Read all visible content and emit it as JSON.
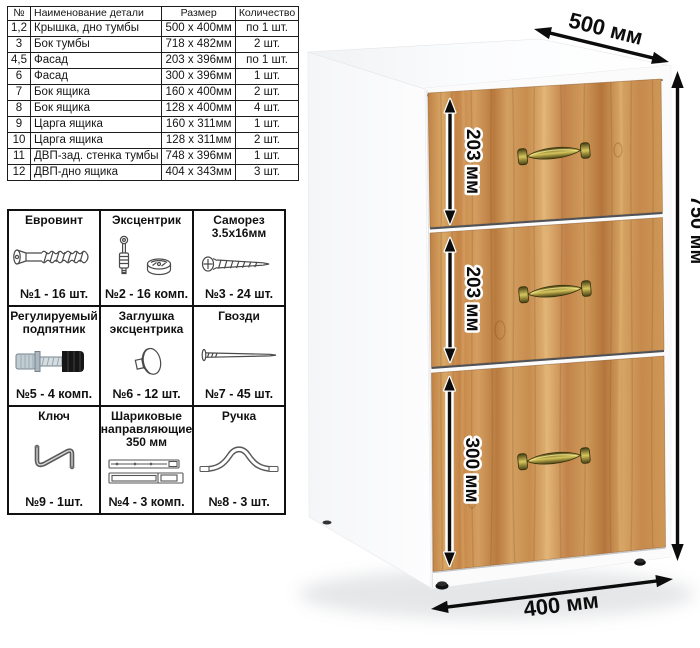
{
  "parts_table": {
    "headers": [
      "№",
      "Наименование детали",
      "Размер",
      "Количество"
    ],
    "rows": [
      {
        "num": "1,2",
        "name": "Крышка, дно тумбы",
        "size": "500 x 400мм",
        "qty": "по 1 шт."
      },
      {
        "num": "3",
        "name": "Бок тумбы",
        "size": "718 x 482мм",
        "qty": "2 шт."
      },
      {
        "num": "4,5",
        "name": "Фасад",
        "size": "203 x 396мм",
        "qty": "по 1 шт."
      },
      {
        "num": "6",
        "name": "Фасад",
        "size": "300 x 396мм",
        "qty": "1 шт."
      },
      {
        "num": "7",
        "name": "Бок ящика",
        "size": "160 x 400мм",
        "qty": "2 шт."
      },
      {
        "num": "8",
        "name": "Бок ящика",
        "size": "128 x 400мм",
        "qty": "4 шт."
      },
      {
        "num": "9",
        "name": "Царга ящика",
        "size": "160 x 311мм",
        "qty": "1 шт."
      },
      {
        "num": "10",
        "name": "Царга ящика",
        "size": "128 x 311мм",
        "qty": "2 шт."
      },
      {
        "num": "11",
        "name": "ДВП-зад. стенка тумбы",
        "size": "748 x 396мм",
        "qty": "1 шт."
      },
      {
        "num": "12",
        "name": "ДВП-дно ящика",
        "size": "404 x 343мм",
        "qty": "3 шт."
      }
    ]
  },
  "hardware": {
    "items": [
      {
        "title": "Евровинт",
        "count": "№1 - 16 шт.",
        "icon": "euro-screw-icon"
      },
      {
        "title": "Эксцентрик",
        "count": "№2 - 16 комп.",
        "icon": "cam-lock-icon"
      },
      {
        "title": "Саморез\n3.5x16мм",
        "count": "№3 - 24 шт.",
        "icon": "self-tapping-screw-icon"
      },
      {
        "title": "Регулируемый\nподпятник",
        "count": "№5 - 4 комп.",
        "icon": "adjustable-foot-icon"
      },
      {
        "title": "Заглушка\nэксцентрика",
        "count": "№6 - 12 шт.",
        "icon": "cam-cover-icon"
      },
      {
        "title": "Гвозди",
        "count": "№7 - 45 шт.",
        "icon": "nail-icon"
      },
      {
        "title": "Ключ",
        "count": "№9 - 1шт.",
        "icon": "hex-key-icon"
      },
      {
        "title": "Шариковые\nнаправляющие\n350 мм",
        "count": "№4 - 3 комп.",
        "icon": "ball-bearing-slides-icon"
      },
      {
        "title": "Ручка",
        "count": "№8 - 3 шт.",
        "icon": "handle-icon"
      }
    ]
  },
  "dimensions": {
    "depth": "500 мм",
    "height": "750 мм",
    "width": "400 мм",
    "drawer1": "203 мм",
    "drawer2": "203 мм",
    "drawer3": "300 мм"
  },
  "colors": {
    "wood": "#c98c4e",
    "handle_brass": "#8f823a",
    "carcass_white": "#fbfbfc",
    "arrow": "#0c0c0c"
  }
}
